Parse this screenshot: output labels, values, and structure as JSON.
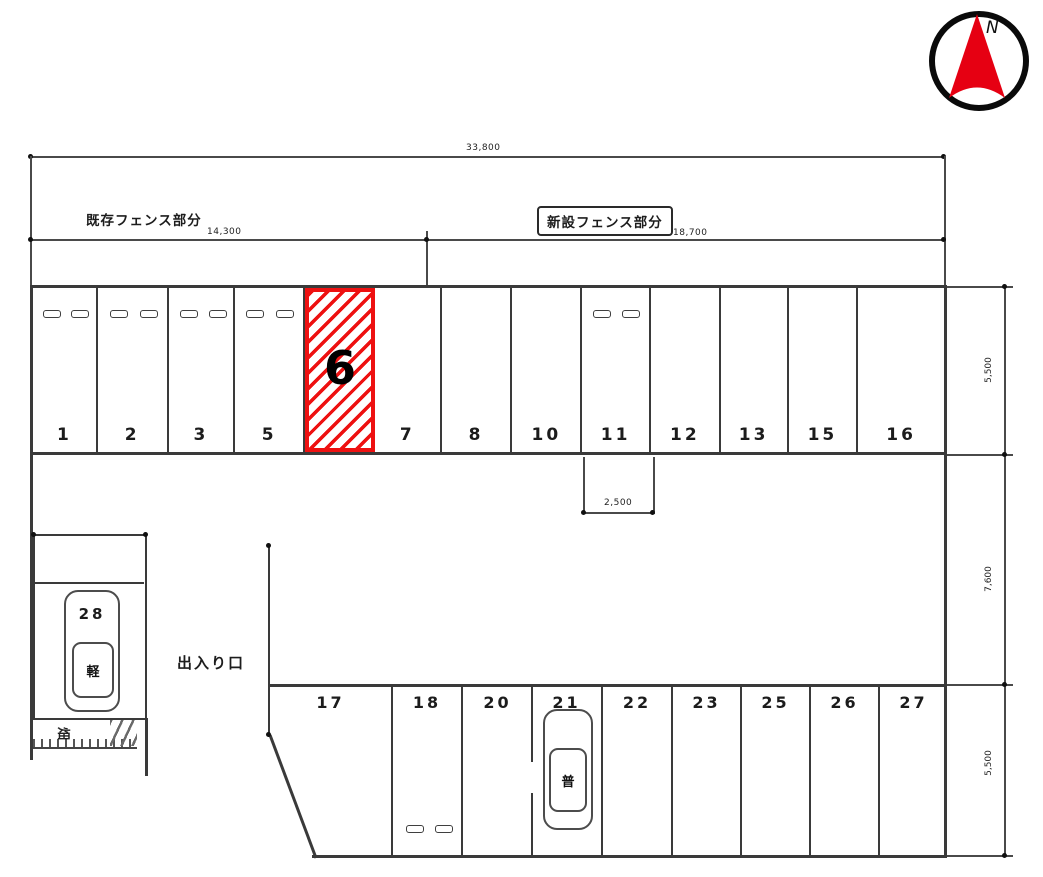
{
  "compass": {
    "north_label": "N"
  },
  "dimensions": {
    "total_width": "33,800",
    "existing_fence_label": "既存フェンス部分",
    "existing_fence_length": "14,300",
    "new_fence_label": "新設フェンス部分",
    "new_fence_length": "18,700",
    "stall_width": "2,500",
    "upper_row_depth": "5,500",
    "middle_depth": "7,600",
    "lower_row_depth": "5,500"
  },
  "stalls": {
    "top_row": [
      {
        "label": "1"
      },
      {
        "label": "2"
      },
      {
        "label": "3"
      },
      {
        "label": "5"
      },
      {
        "label": "6",
        "highlighted": true
      },
      {
        "label": "7"
      },
      {
        "label": "8"
      },
      {
        "label": "10"
      },
      {
        "label": "11"
      },
      {
        "label": "12"
      },
      {
        "label": "13"
      },
      {
        "label": "15"
      },
      {
        "label": "16"
      }
    ],
    "bottom_row": [
      {
        "label": "17"
      },
      {
        "label": "18"
      },
      {
        "label": "20"
      },
      {
        "label": "21",
        "vehicle_type": "普"
      },
      {
        "label": "22"
      },
      {
        "label": "23"
      },
      {
        "label": "25"
      },
      {
        "label": "26"
      },
      {
        "label": "27"
      }
    ],
    "kei_stall": {
      "label": "28",
      "vehicle_type": "軽"
    }
  },
  "labels": {
    "entrance": "出入り口",
    "field": "畑"
  },
  "colors": {
    "highlight_red": "#ee1111",
    "compass_red": "#e60012",
    "line": "#3a3a3a"
  }
}
